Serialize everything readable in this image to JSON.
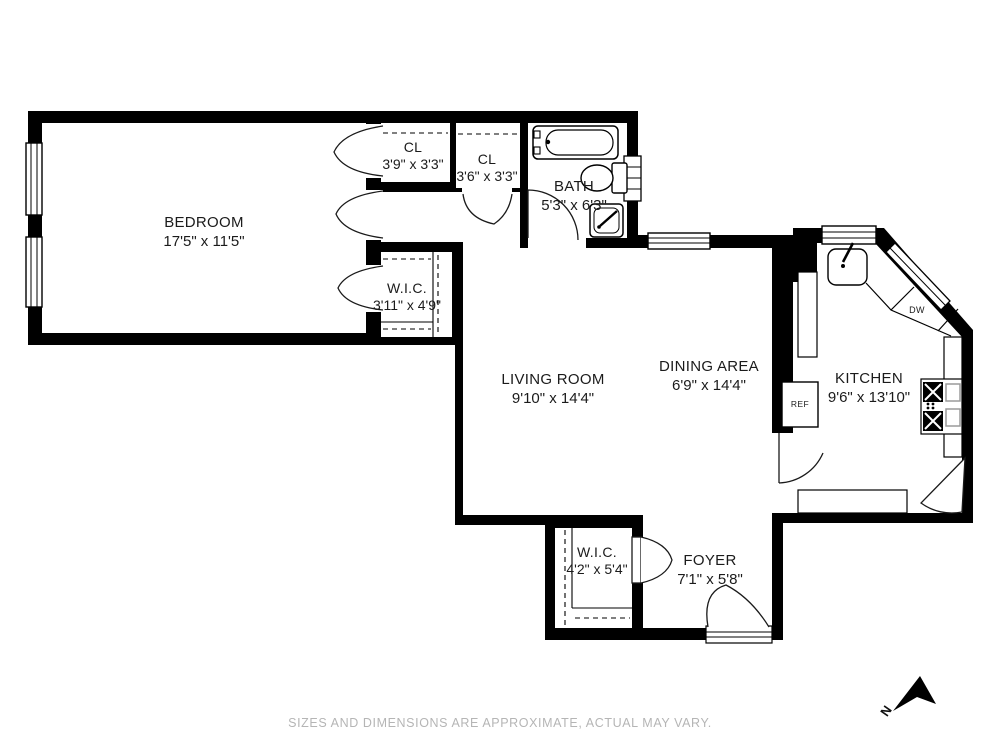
{
  "plan": {
    "rooms": [
      {
        "id": "bedroom",
        "name": "BEDROOM",
        "dims": "17'5\" x 11'5\""
      },
      {
        "id": "cl1",
        "name": "CL",
        "dims": "3'9\" x 3'3\""
      },
      {
        "id": "cl2",
        "name": "CL",
        "dims": "3'6\" x 3'3\""
      },
      {
        "id": "bath",
        "name": "BATH",
        "dims": "5'3\" x 6'3\""
      },
      {
        "id": "wic1",
        "name": "W.I.C.",
        "dims": "3'11\" x 4'9\""
      },
      {
        "id": "living",
        "name": "LIVING ROOM",
        "dims": "9'10\" x 14'4\""
      },
      {
        "id": "dining",
        "name": "DINING AREA",
        "dims": "6'9\" x 14'4\""
      },
      {
        "id": "kitchen",
        "name": "KITCHEN",
        "dims": "9'6\" x 13'10\""
      },
      {
        "id": "wic2",
        "name": "W.I.C.",
        "dims": "4'2\" x 5'4\""
      },
      {
        "id": "foyer",
        "name": "FOYER",
        "dims": "7'1\" x 5'8\""
      }
    ],
    "appliances": {
      "refrigerator": "REF",
      "dishwasher": "DW"
    },
    "compass": {
      "north_label": "N"
    },
    "disclaimer": "SIZES AND DIMENSIONS ARE APPROXIMATE, ACTUAL MAY VARY.",
    "colors": {
      "wall": "#000000",
      "background": "#ffffff",
      "disclaimer_text": "#b5b5b5",
      "label_text": "#1b1b1b"
    }
  }
}
